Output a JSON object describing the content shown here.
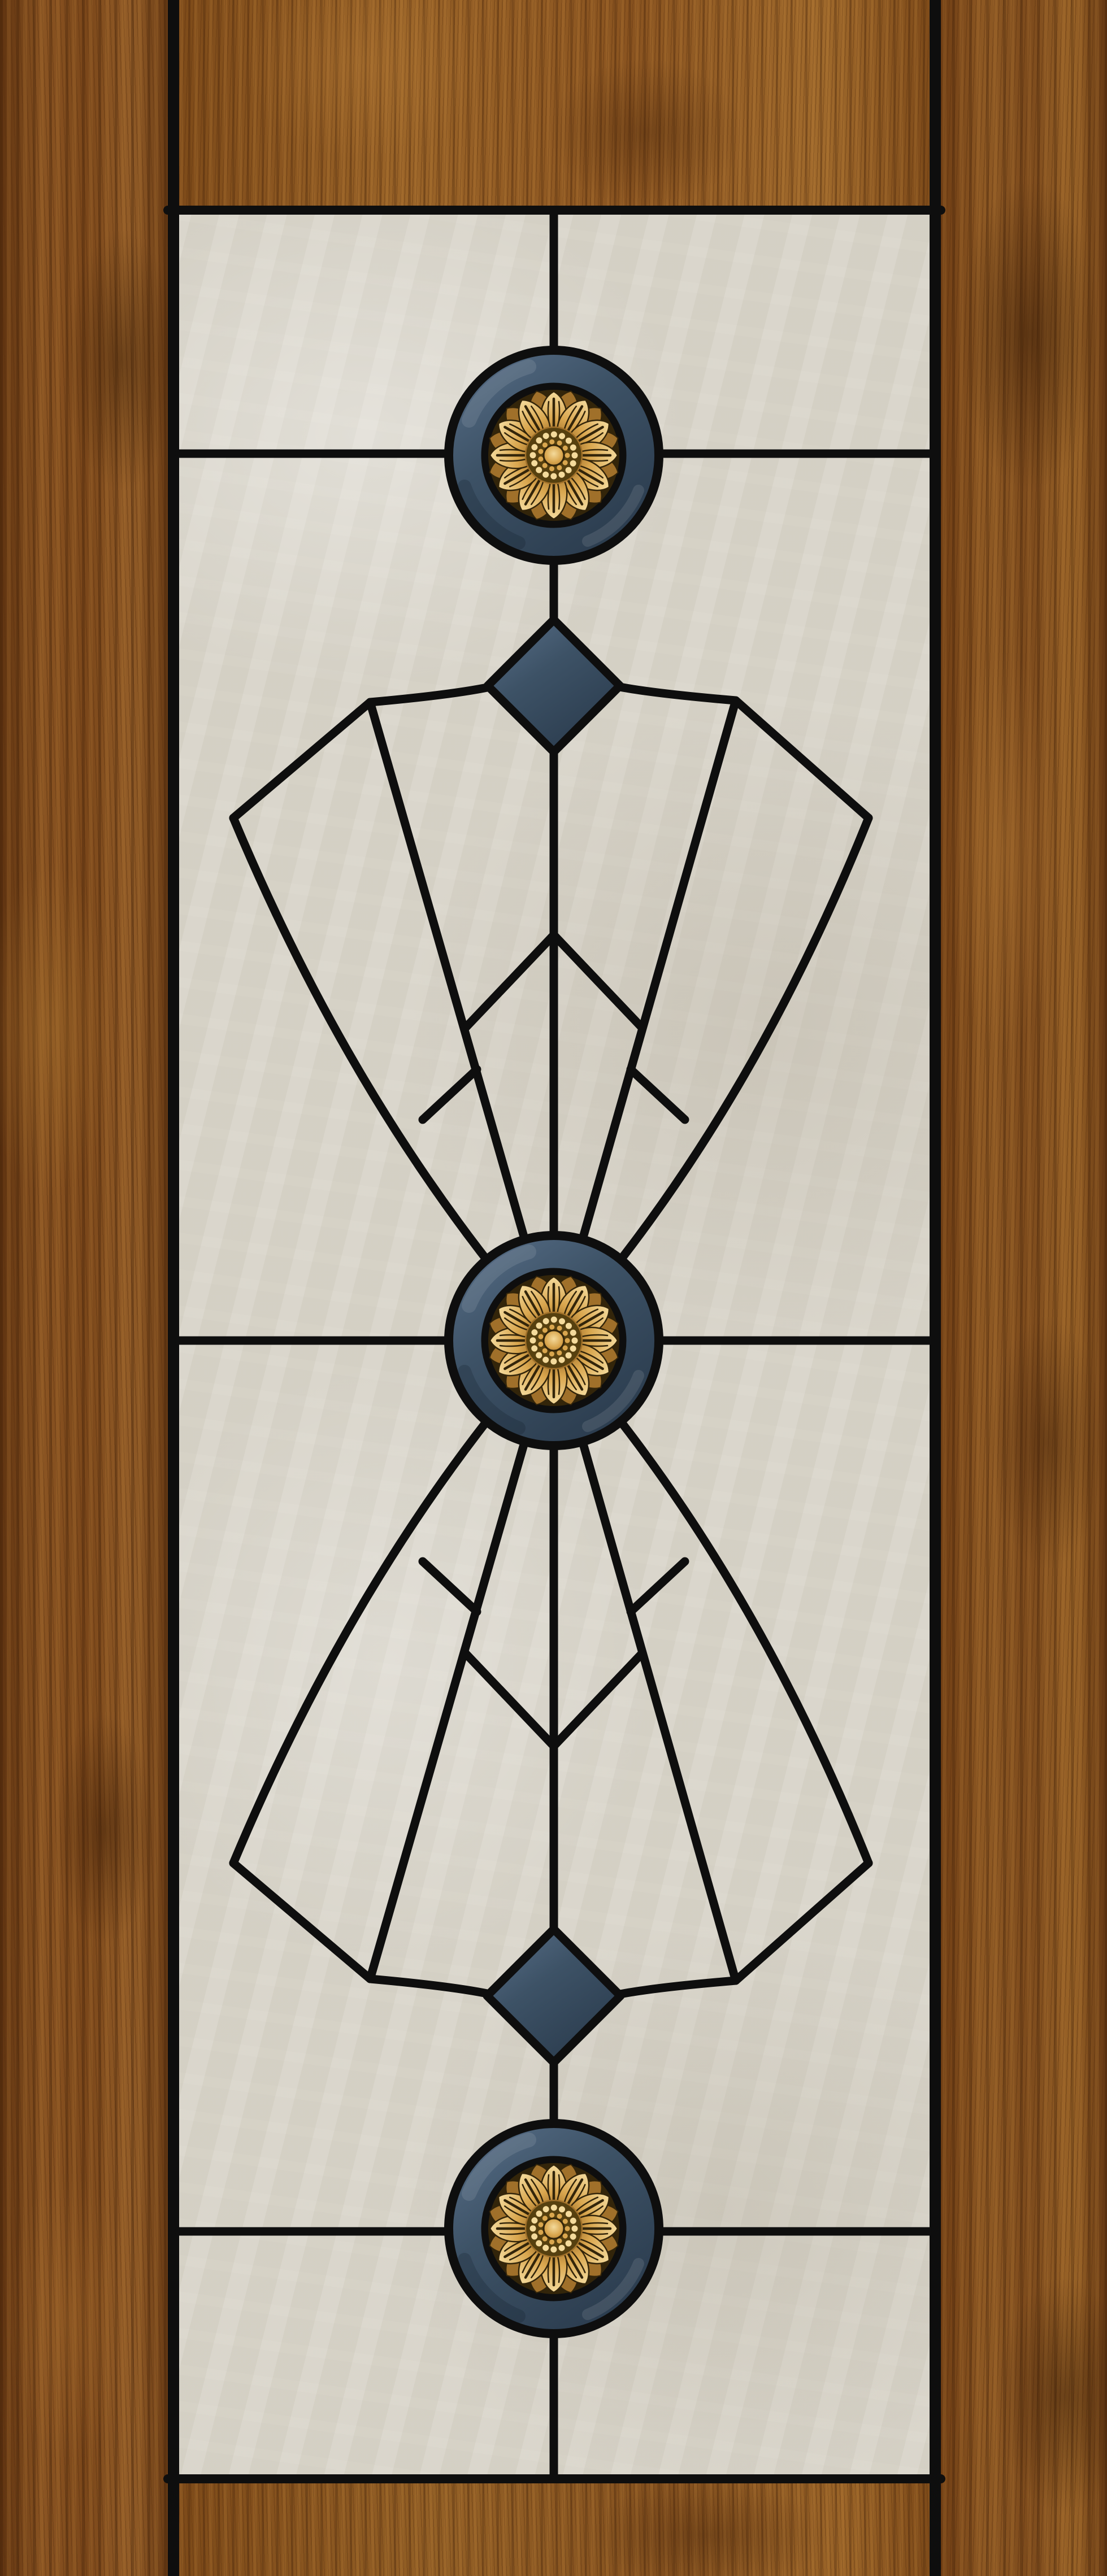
{
  "meta": {
    "description": "Wooden door with an Art Deco stained glass insert: three gold sunflower rosette medallions on slate-blue rings, two slate diamonds, and mirrored fan motifs of black lead lines over pale marbled glass, framed by walnut wood stiles and rails"
  },
  "colors": {
    "lead": "#0e0e0e",
    "glass": "#d8d4c9",
    "glass_light": "#e6e2d9",
    "glass_shadow": "#c7c2b4",
    "slate_light": "#59708a",
    "slate": "#3d5266",
    "slate_dark": "#2b3c4e",
    "gold_light": "#f4da9b",
    "gold": "#d9a64e",
    "gold_dark": "#a0702a",
    "bronze": "#56400f",
    "bronze_deep": "#33250a",
    "wood_light": "#a5702f",
    "wood_mid": "#84511d",
    "wood_dark": "#6a3c14",
    "wood_deep": "#43250c",
    "rail_mid": "#8a5721"
  },
  "scene": {
    "type": "door-with-stained-glass",
    "medallions": [
      {
        "name": "sunflower-medallion-top",
        "petal_count": 12
      },
      {
        "name": "sunflower-medallion-center",
        "petal_count": 12
      },
      {
        "name": "sunflower-medallion-bottom",
        "petal_count": 12
      }
    ],
    "diamonds": [
      {
        "name": "slate-diamond-top"
      },
      {
        "name": "slate-diamond-bottom"
      }
    ],
    "fans": [
      {
        "name": "upper-fan-motif"
      },
      {
        "name": "lower-fan-motif"
      }
    ],
    "frame_parts": [
      "left-wood-stile",
      "right-wood-stile",
      "top-wood-rail",
      "bottom-wood-rail"
    ]
  }
}
